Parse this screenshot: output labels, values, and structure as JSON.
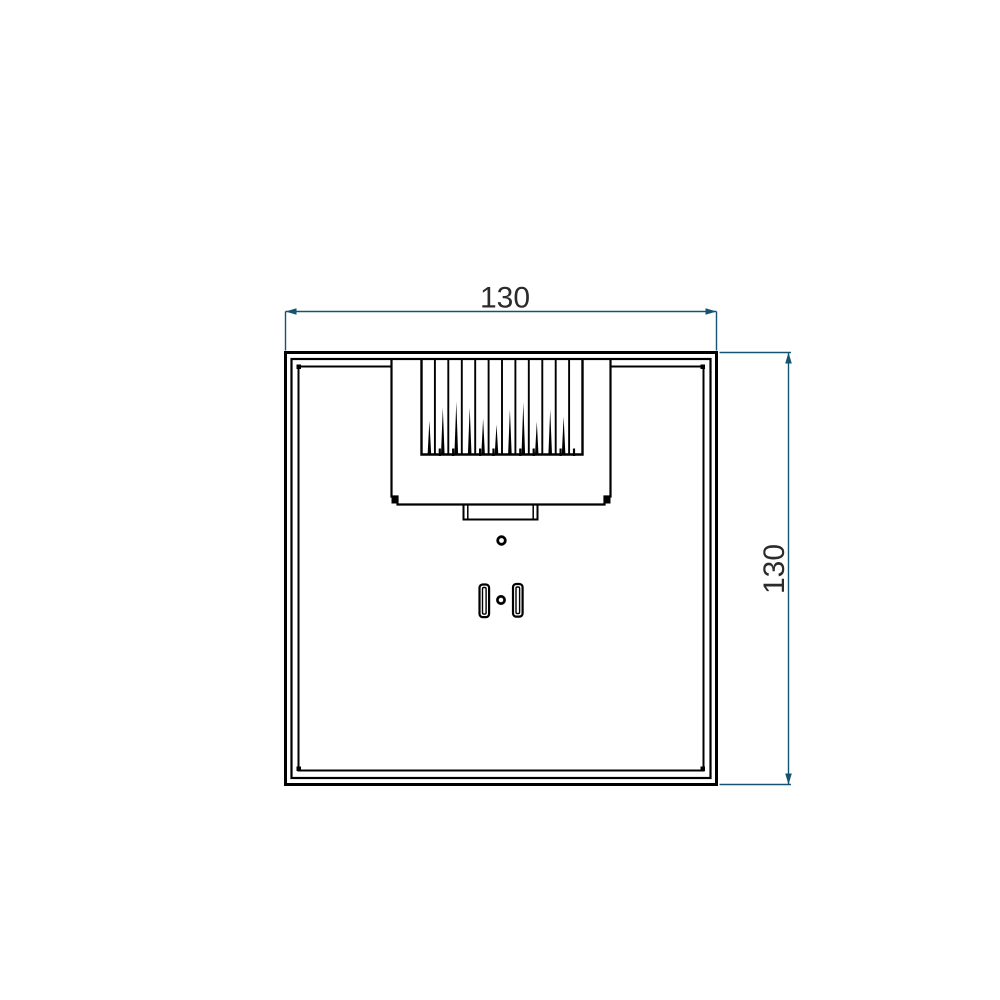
{
  "drawing": {
    "view": "top-view-technical-drawing",
    "dimensions": {
      "width": {
        "label": "130"
      },
      "height": {
        "label": "130"
      }
    },
    "colors": {
      "line": "#000000",
      "dimension": "#155370",
      "text": "#2b2b2b",
      "background": "#ffffff"
    }
  }
}
